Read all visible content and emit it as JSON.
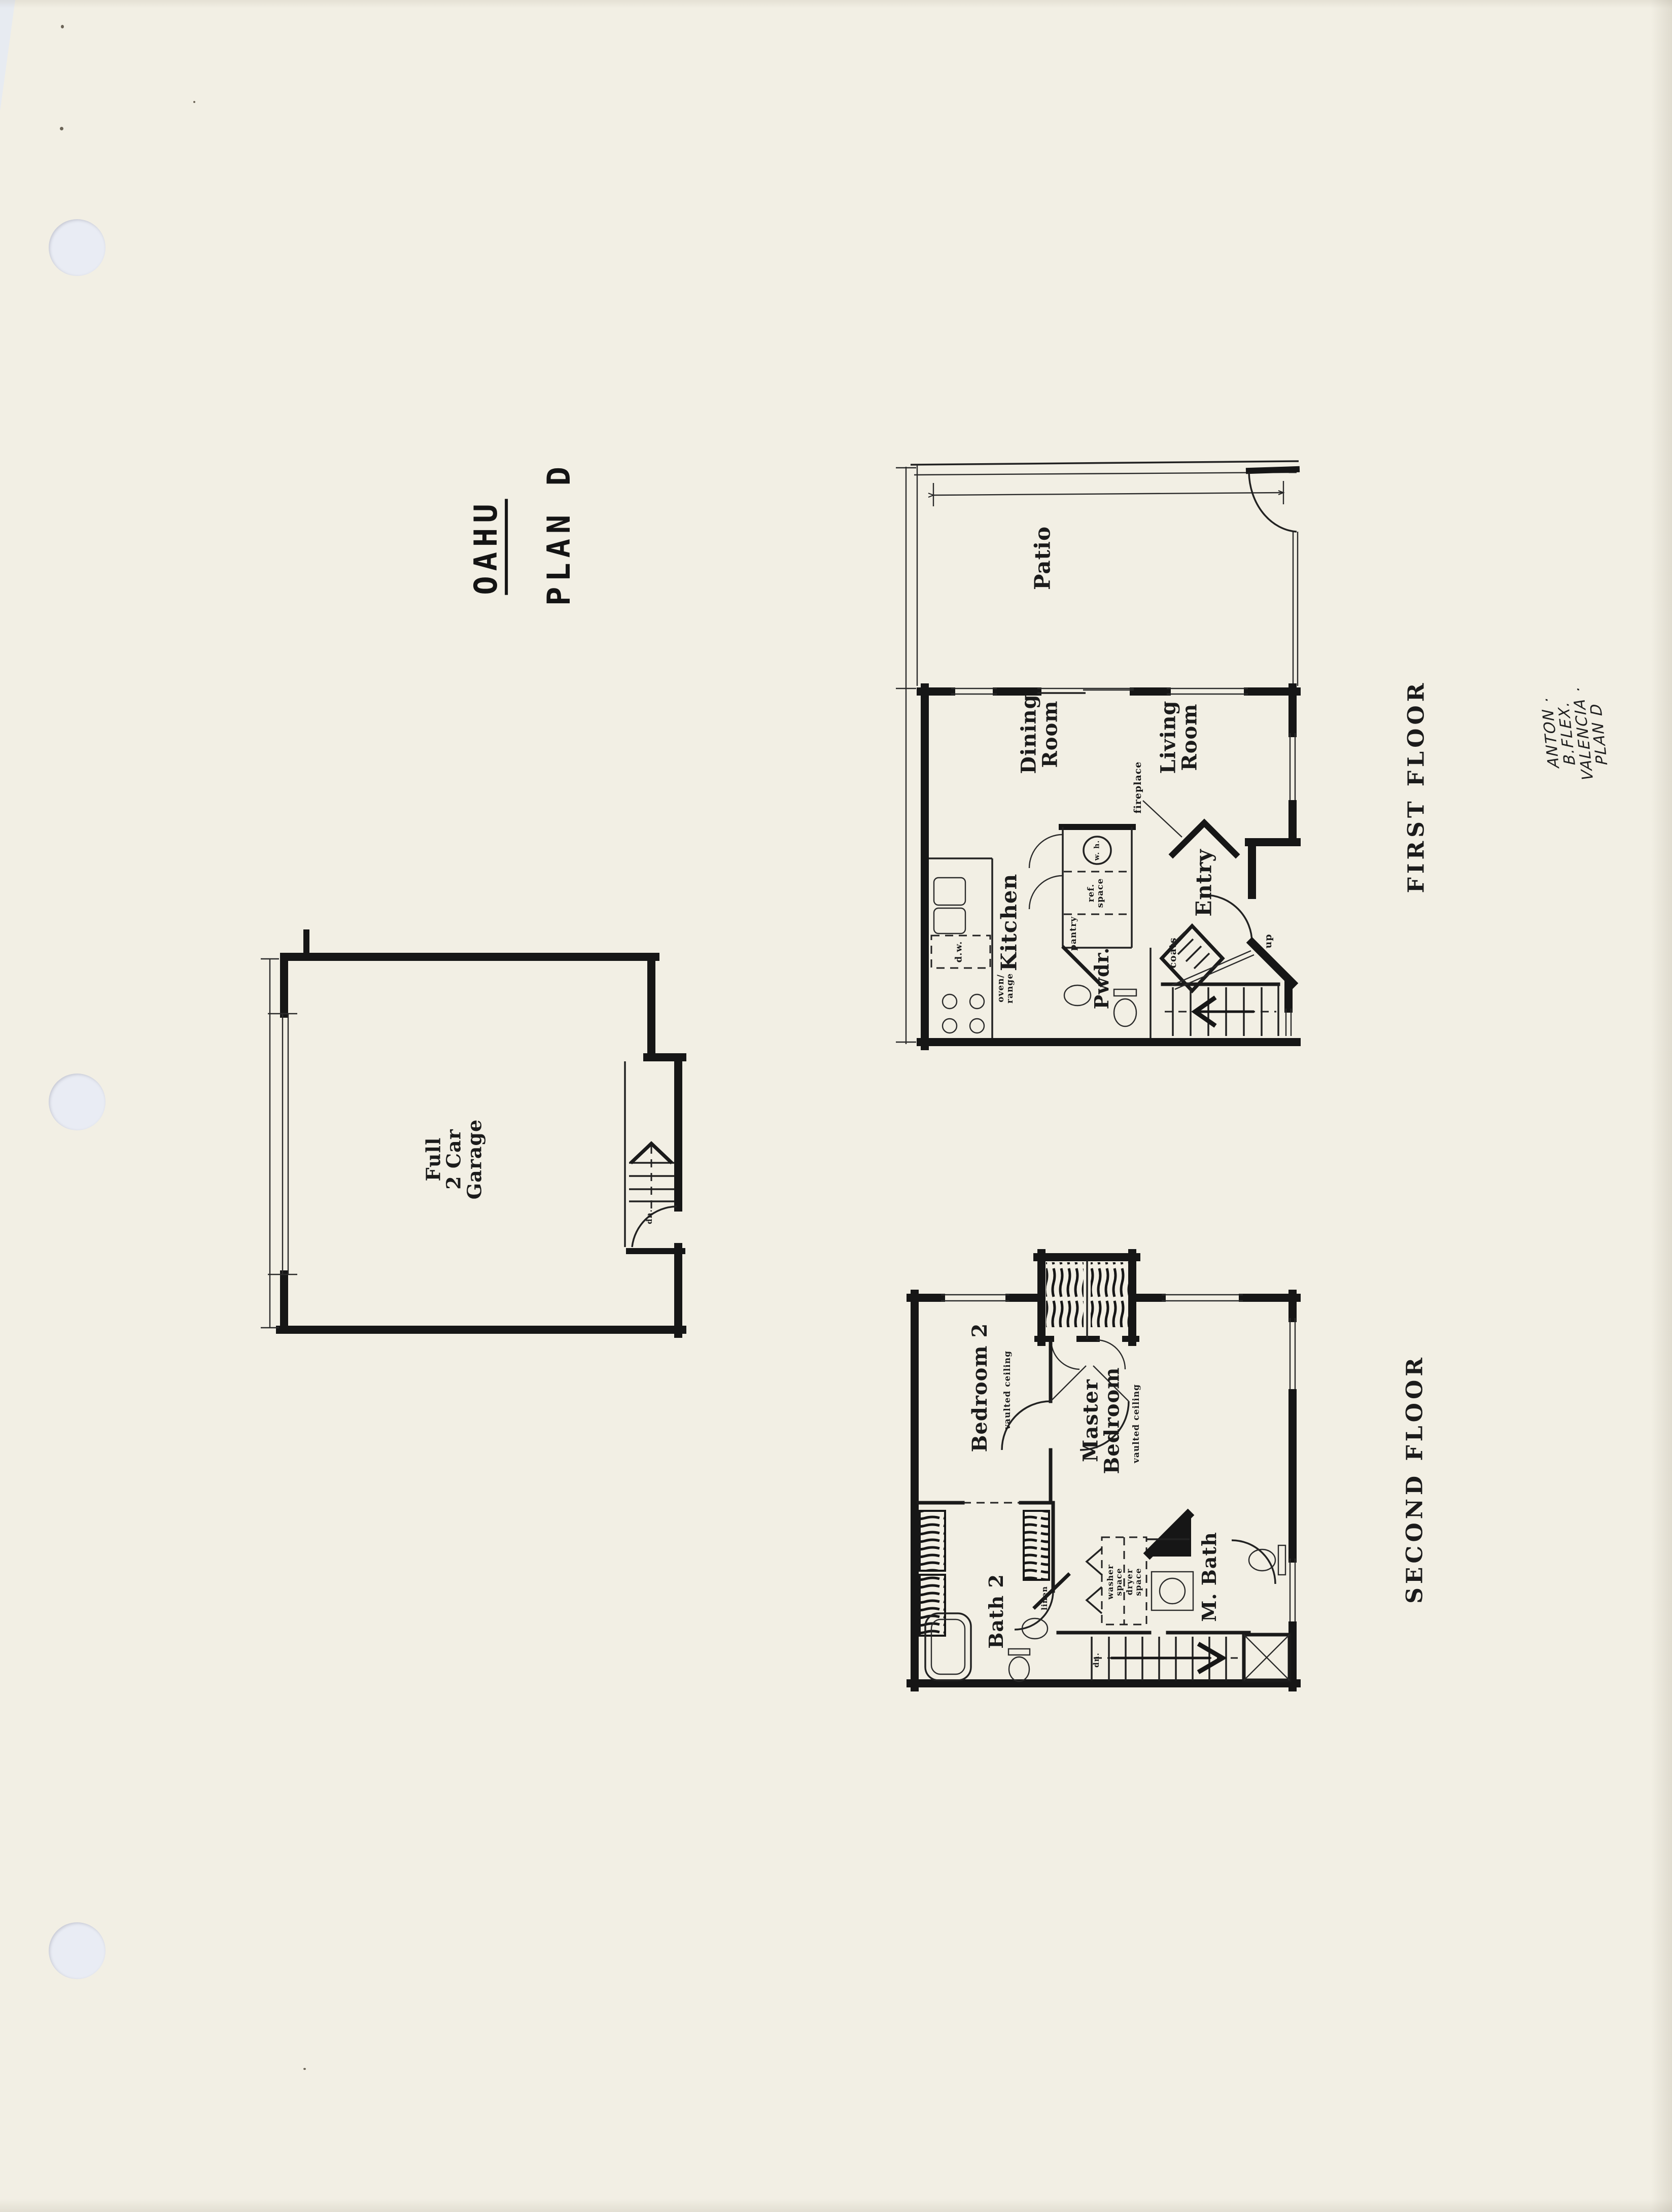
{
  "sheet": {
    "type": "scanned floor plan sheet",
    "hole_punch_count": 3,
    "colors": {
      "paper": "#f2efe4",
      "ink": "#161616",
      "hole": "#e9ecf4"
    }
  },
  "titles": {
    "project": "OAHU",
    "plan": "PLAN D",
    "first_floor": "FIRST FLOOR",
    "second_floor": "SECOND FLOOR"
  },
  "handwritten_note": "ANTON · B.FLEX. VALENCIA · PLAN D",
  "first_floor": {
    "patio": "Patio",
    "dining": "Dining\nRoom",
    "living": "Living\nRoom",
    "kitchen": "Kitchen",
    "entry": "Entry",
    "powder": "Pwdr.",
    "fireplace": "fireplace",
    "coats": "coats",
    "up": "up",
    "water_heater": "w. h.",
    "ref_space": "ref.\nspace",
    "pantry": "pantry",
    "dishwasher": "d.w.",
    "oven_range": "oven/\nrange"
  },
  "garage": {
    "label": "Full\n2 Car\nGarage",
    "down": "dn."
  },
  "second_floor": {
    "bedroom2": "Bedroom 2",
    "bedroom2_note": "vaulted ceiling",
    "master": "Master\nBedroom",
    "master_note": "vaulted ceiling",
    "bath2": "Bath 2",
    "master_bath": "M. Bath",
    "linen": "linen",
    "washer": "washer\nspace",
    "dryer": "dryer\nspace",
    "down": "dn."
  }
}
